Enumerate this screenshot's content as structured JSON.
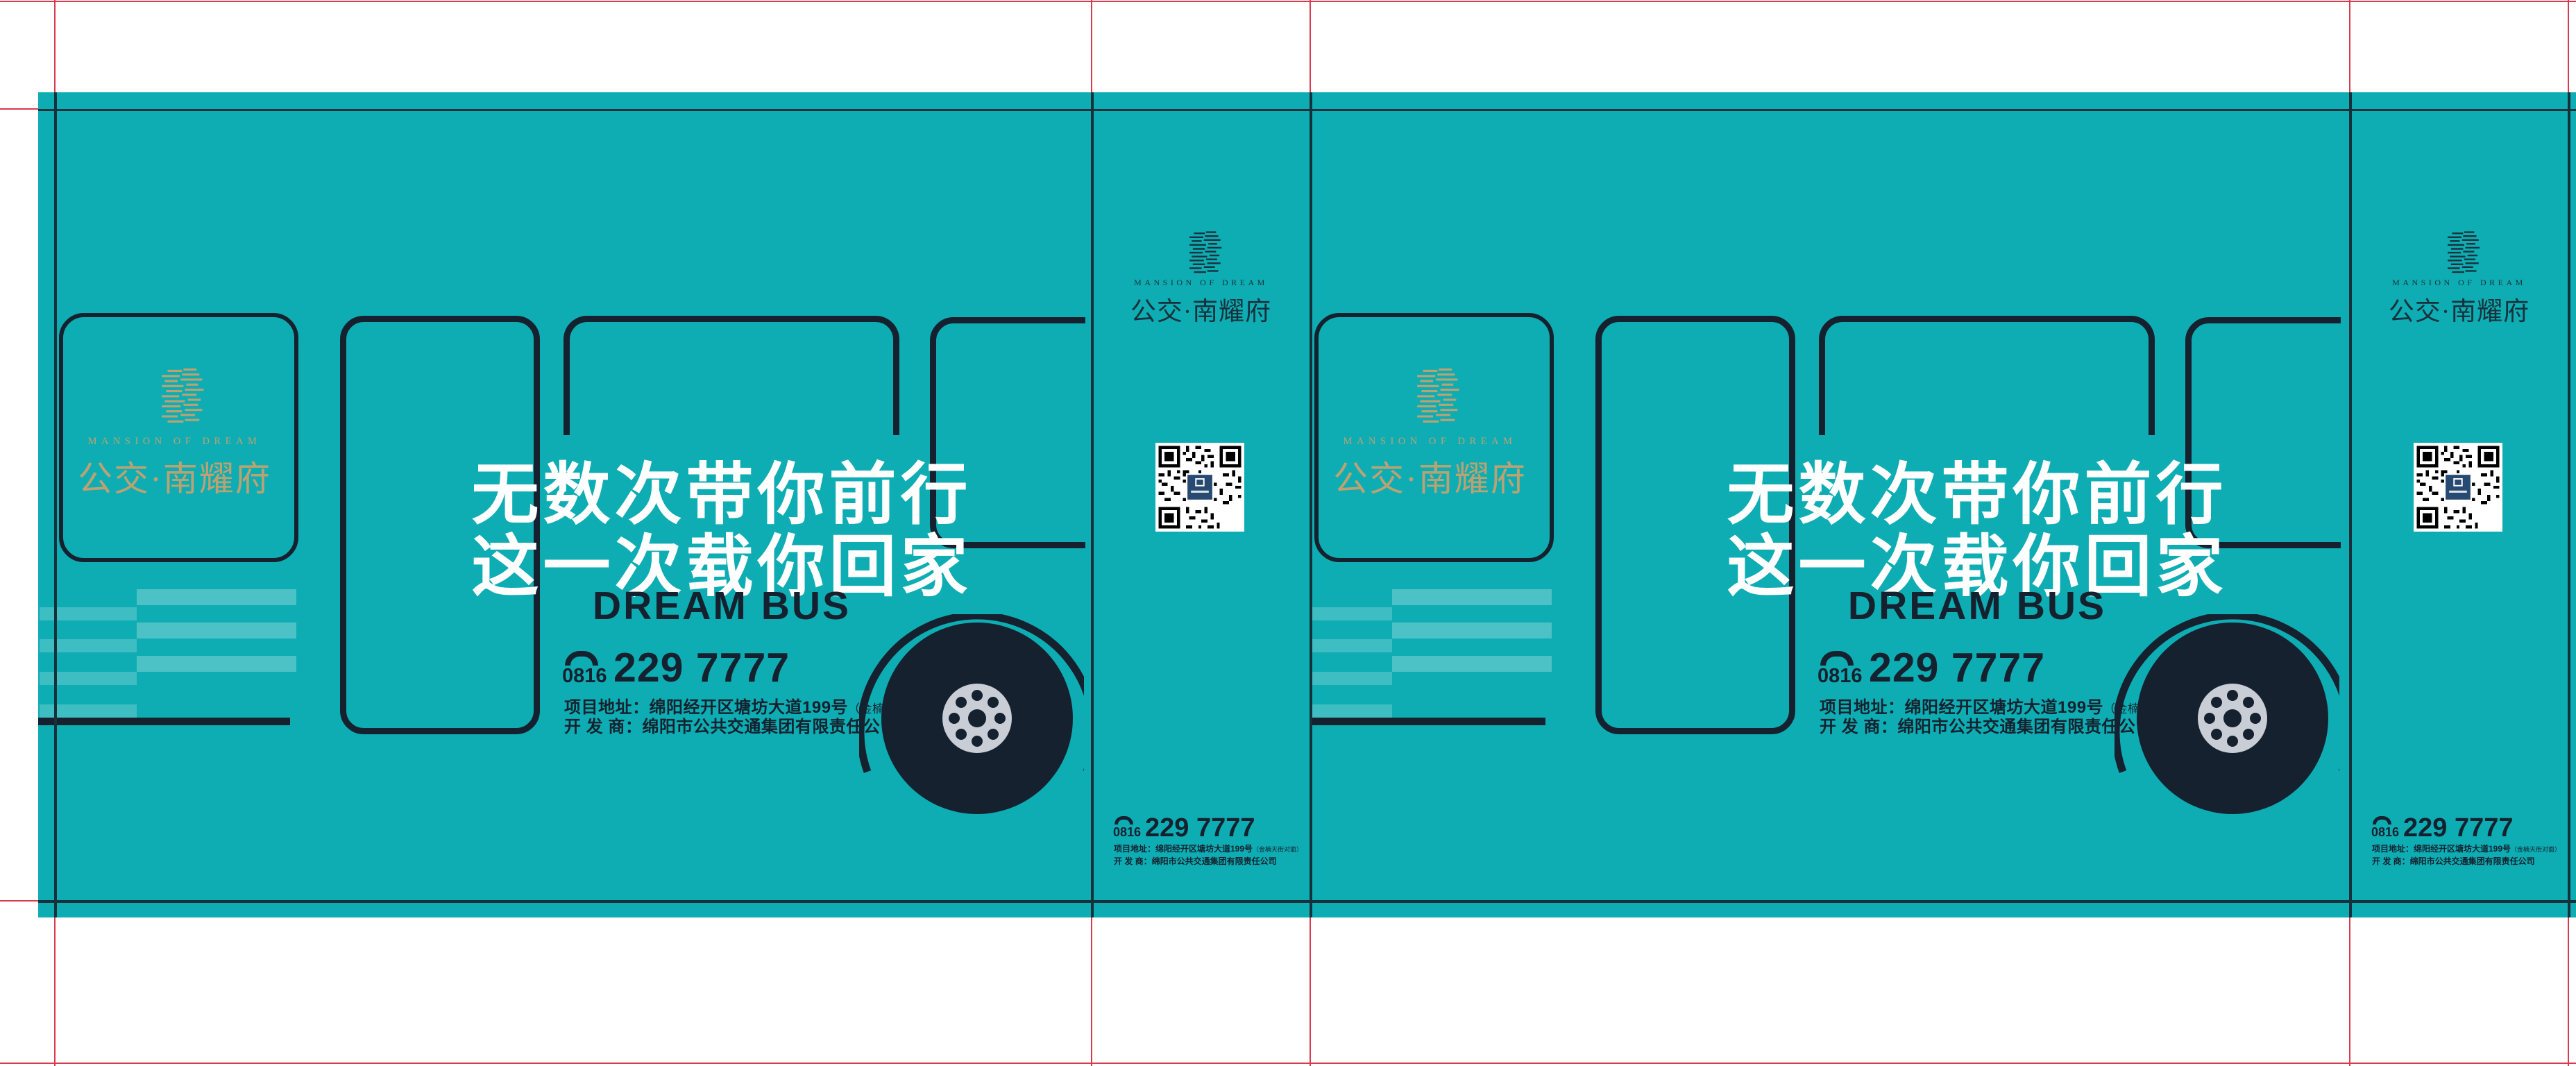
{
  "document": {
    "type": "bus-wrap print proof",
    "colors": {
      "teal": "#0eadb3",
      "navy": "#15212e",
      "gold": "#bda271",
      "crop_red": "#d83a50",
      "hub_gray": "#c9cdd6",
      "qr_center": "#274a72"
    }
  },
  "side": {
    "brand_en": "MANSION OF DREAM",
    "brand_zh": "公交·南耀府",
    "headline1": "无数次带你前行",
    "headline2": "这一次载你回家",
    "tagline": "DREAM BUS",
    "phone_area": "0816",
    "phone_number": "229 7777",
    "address_line": "项目地址：绵阳经开区塘坊大道199号",
    "address_note": "（金楠天街对面）",
    "developer_line": "开 发 商：绵阳市公共交通集团有限责任公司"
  },
  "front": {
    "brand_en": "MANSION OF DREAM",
    "brand_zh": "公交·南耀府",
    "phone_area": "0816",
    "phone_number": "229 7777",
    "address_line": "项目地址：绵阳经开区塘坊大道199号",
    "address_note": "（金楠天街对面）",
    "developer_line": "开 发 商：绵阳市公共交通集团有限责任公司"
  }
}
